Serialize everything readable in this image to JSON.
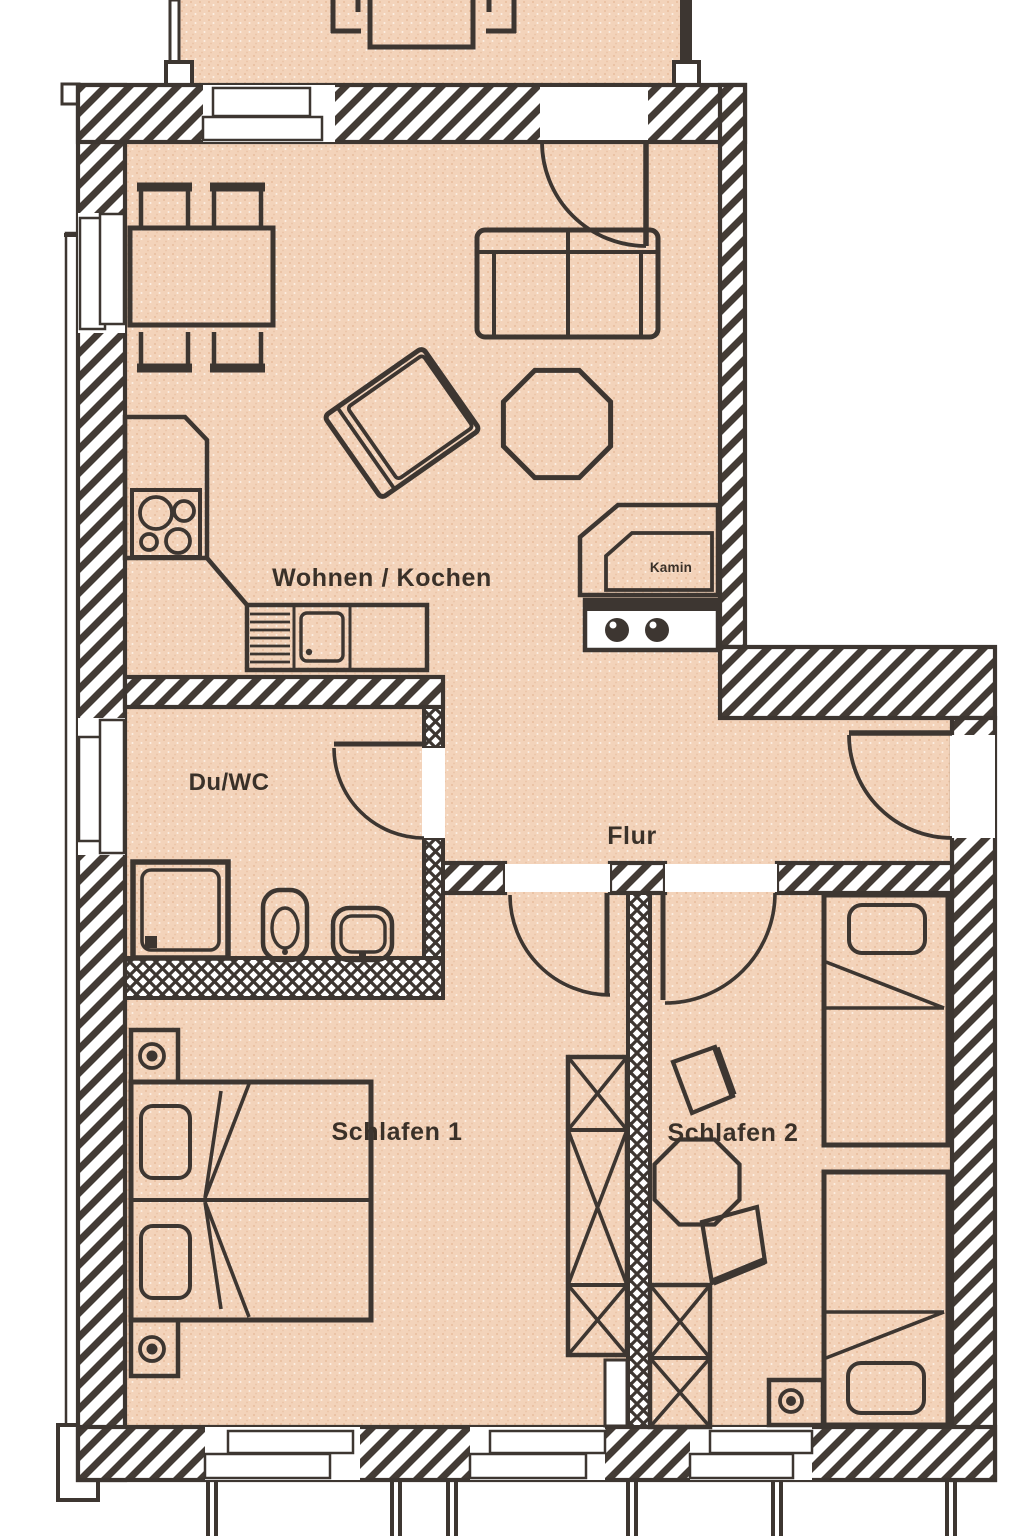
{
  "rooms": {
    "living_kitchen": {
      "label": "Wohnen / Kochen"
    },
    "shower_wc": {
      "label": "Du/WC"
    },
    "hallway": {
      "label": "Flur"
    },
    "bedroom_1": {
      "label": "Schlafen 1"
    },
    "bedroom_2": {
      "label": "Schlafen 2"
    }
  },
  "fixtures": {
    "chimney_block": {
      "label": "Kamin"
    }
  },
  "colors": {
    "floor": "#f3d3ba",
    "wall_fill": "#ffffff",
    "line": "#3d3631",
    "label_text": "#3a3129"
  }
}
